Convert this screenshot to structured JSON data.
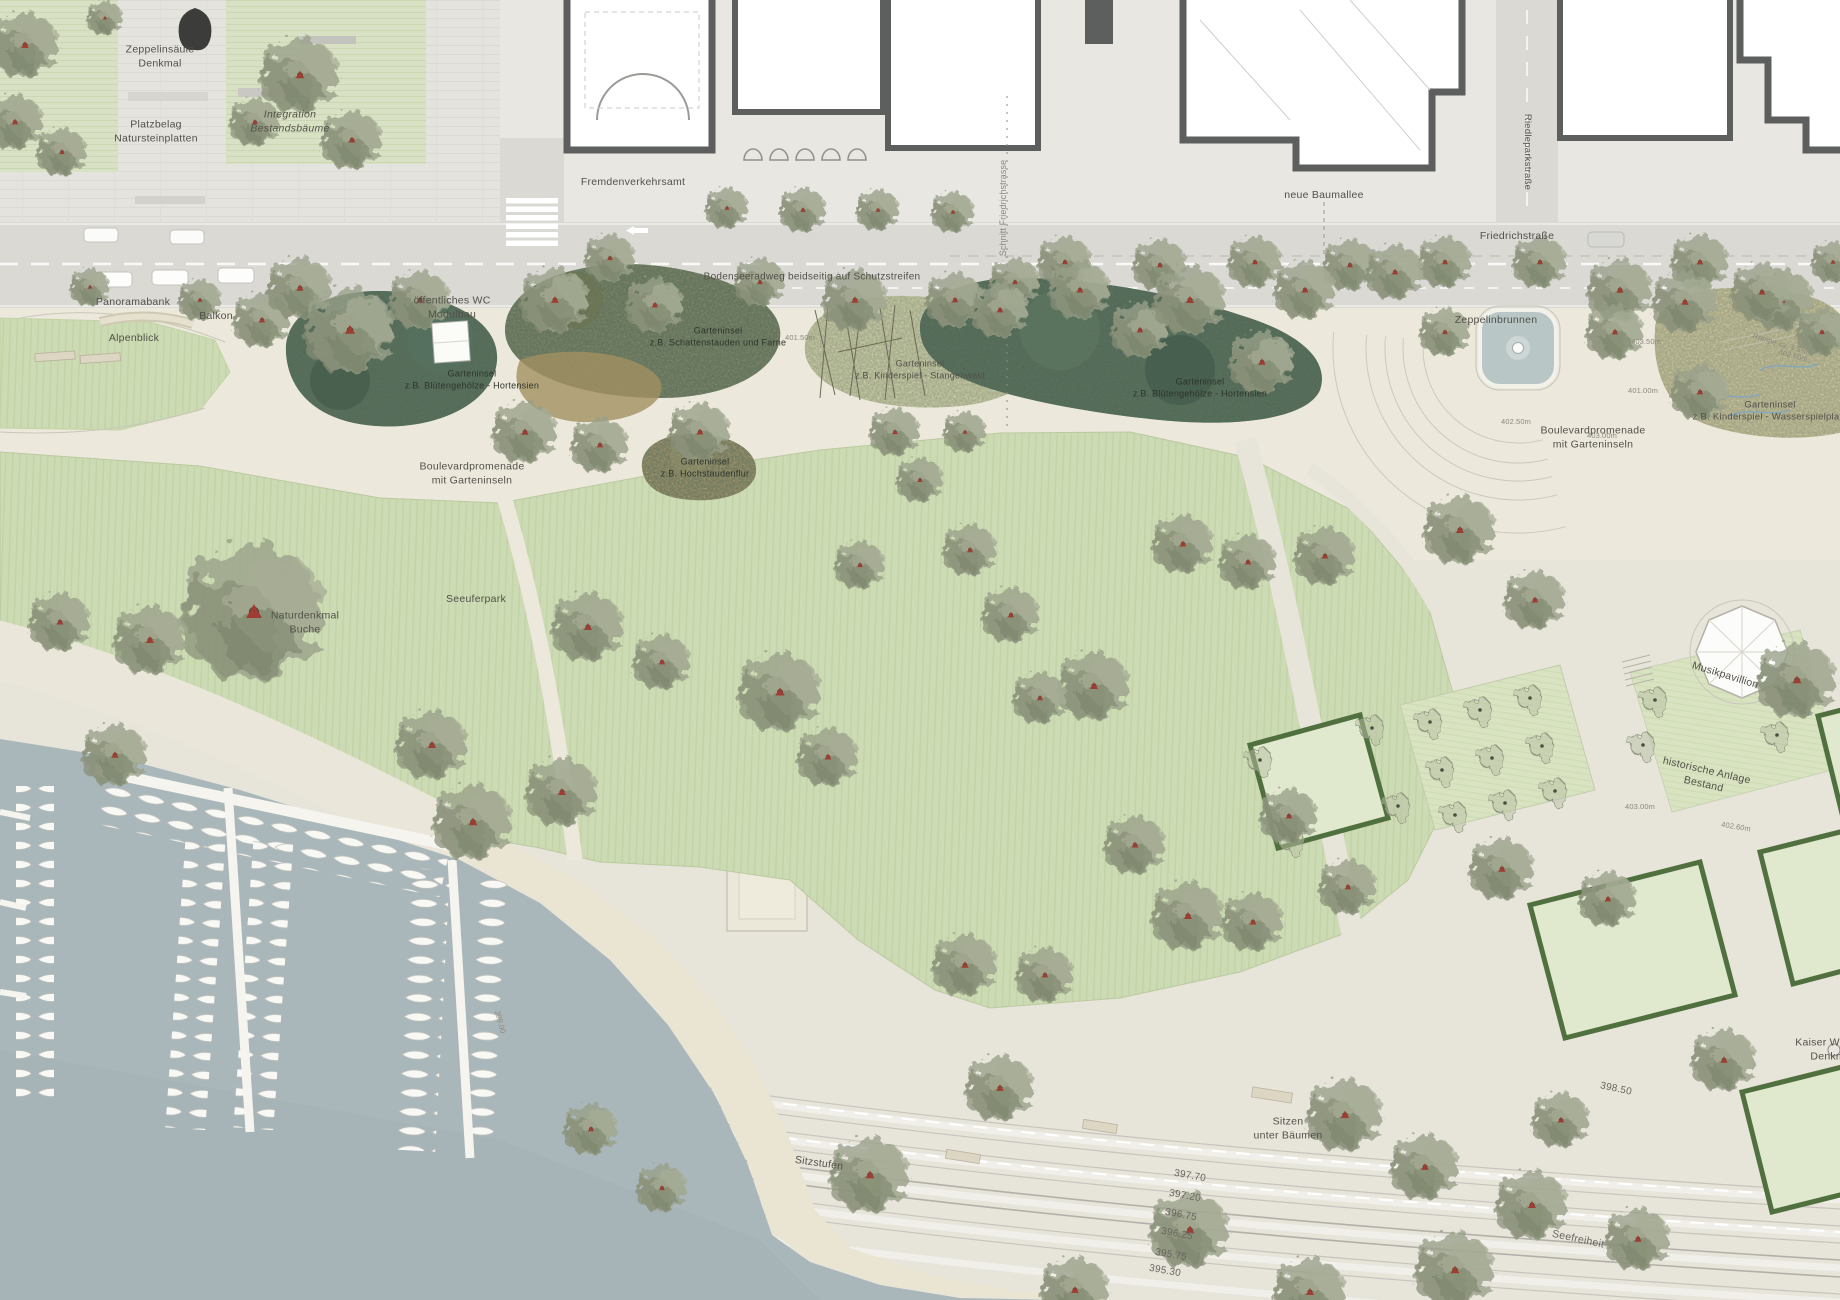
{
  "map_labels": {
    "zeppelinsaeule_1": "Zeppelinsäule",
    "zeppelinsaeule_2": "Denkmal",
    "platzbelag_1": "Platzbelag",
    "platzbelag_2": "Natursteinplatten",
    "integration_1": "Integration",
    "integration_2": "Bestandsbäume",
    "fremdenverkehrsamt": "Fremdenverkehrsamt",
    "schnitt": "Schnitt Friedrichstrasse",
    "neue_baumallee": "neue Baumallee",
    "friedrichstrasse": "Friedrichstraße",
    "riedleparkstrasse": "Riedleparkstraße",
    "bodenseeradweg": "Bodenseeradweg beidseitig auf Schutzstreifen",
    "panoramabank": "Panoramabank",
    "balkon": "Balkon",
    "alpenblick": "Alpenblick",
    "wc_1": "öffentliches WC",
    "wc_2": "Modulbau",
    "zeppelinbrunnen": "Zeppelinbrunnen",
    "boulevard_left_1": "Boulevardpromenade",
    "boulevard_left_2": "mit Garteninseln",
    "boulevard_right_1": "Boulevardpromenade",
    "boulevard_right_2": "mit Garteninseln",
    "naturdenkmal_1": "Naturdenkmal",
    "naturdenkmal_2": "Buche",
    "seeuferpark": "Seeuferpark",
    "musikpavillion": "Musikpavillion",
    "historische_1": "historische Anlage",
    "historische_2": "Bestand",
    "kaiser_1": "Kaiser Wilhelm",
    "kaiser_2": "Denkmal",
    "sitzen_1": "Sitzen",
    "sitzen_2": "unter Bäumen",
    "sitzstufen": "Sitzstufen",
    "seefreiheit": "Seefreiheit",
    "rampe": "Rampe ca. 4.5%",
    "level_398": "398.50"
  },
  "garden_islands": [
    {
      "line1": "Garteninsel",
      "line2": "z.B. Blütengehölze - Hortensien"
    },
    {
      "line1": "Garteninsel",
      "line2": "z.B. Schattenstauden und Farne"
    },
    {
      "line1": "Garteninsel",
      "line2": "z.B. Hochstaudenflur"
    },
    {
      "line1": "Garteninsel",
      "line2": "z.B. Kinderspiel - Stangenwald"
    },
    {
      "line1": "Garteninsel",
      "line2": "z.B. Blütengehölze - Hortensien"
    },
    {
      "line1": "Garteninsel",
      "line2": "z.B. Kinderspiel - Wasserspielplatz"
    }
  ],
  "shore_levels": [
    "397.70",
    "397.20",
    "396.75",
    "396.25",
    "395.75",
    "395.30"
  ],
  "elevation_marks": [
    "403.50m",
    "403.00m",
    "402.50m",
    "402.50m",
    "401.50m",
    "401.00m",
    "403.00m",
    "402.60m",
    "399.00"
  ],
  "colors": {
    "water": "#aab7ba",
    "lawn": "#ccdbb3",
    "promenade": "#ece9dc",
    "paving": "#e7e4da",
    "street": "#dad9d4",
    "building_wall": "#5d5e5e",
    "hedge": "#51703f",
    "island_dark_green": "#4d6753",
    "island_olive": "#8a8a66",
    "island_tan": "#b39b6d",
    "island_pale": "#d9d6ae",
    "island_sand": "#d6cba2",
    "tree": "#959a88",
    "label_text": "#52504a",
    "fountain_water": "#b9c6c6",
    "monument": "#3c3c3a",
    "tree_marker_red": "#9e3d31"
  }
}
